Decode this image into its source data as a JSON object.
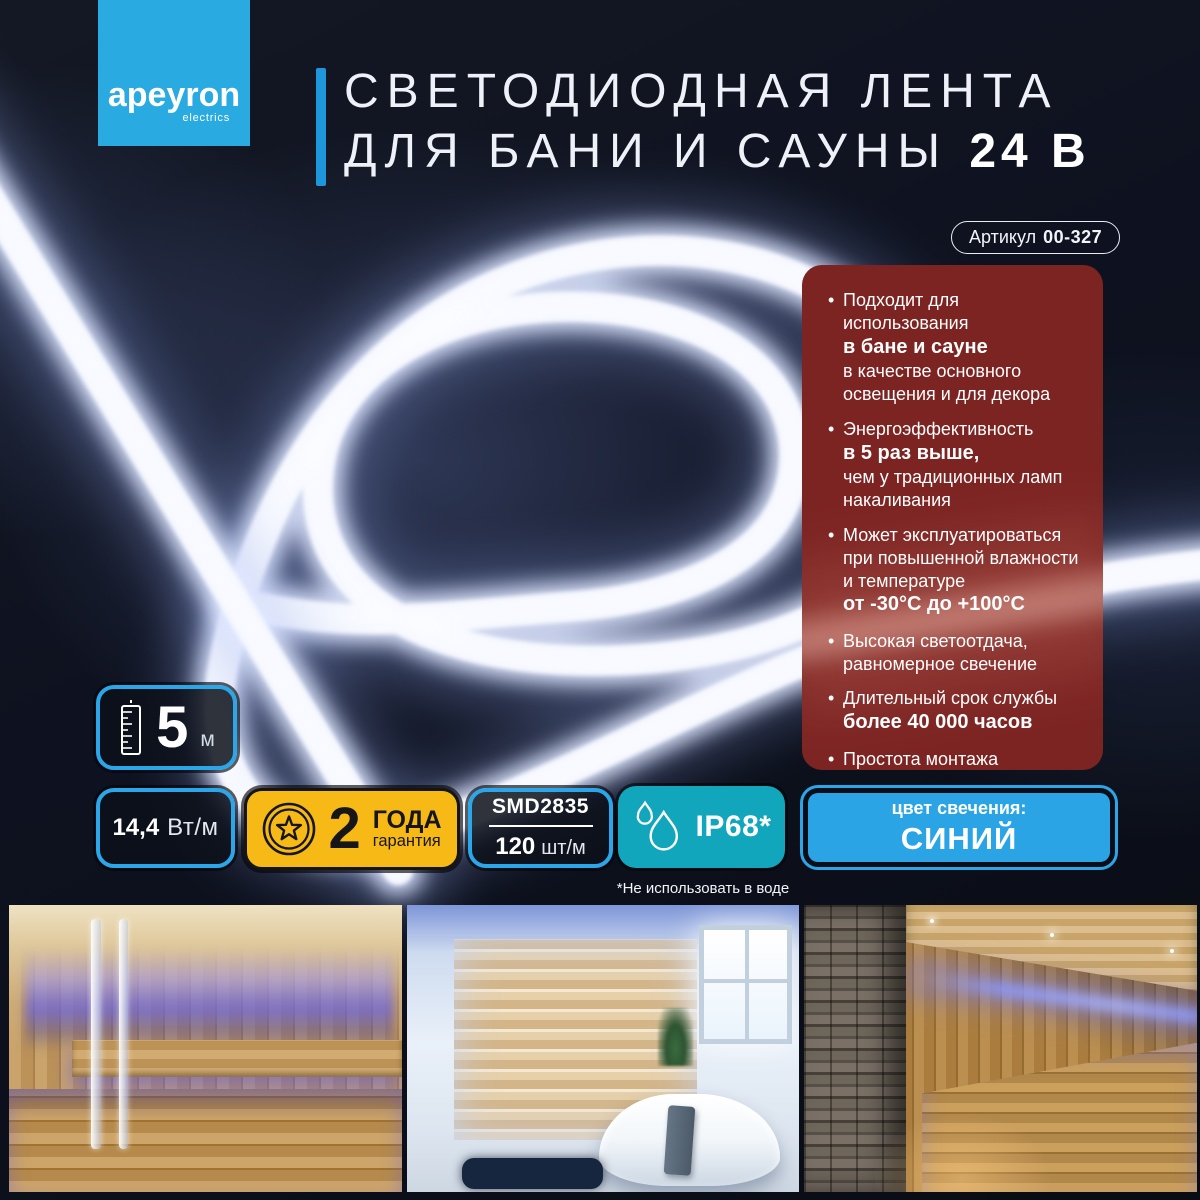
{
  "brand": {
    "name": "apeyron",
    "tagline": "electrics"
  },
  "title": {
    "line1": "СВЕТОДИОДНАЯ ЛЕНТА",
    "line2": "ДЛЯ БАНИ И САУНЫ",
    "voltage": "24 В"
  },
  "article": {
    "label": "Артикул",
    "number": "00-327"
  },
  "features": {
    "items": [
      {
        "t1": "Подходит для использования",
        "b": "в бане и сауне",
        "t2": "в качестве основного освещения и для декора"
      },
      {
        "t1": "Энергоэффективность",
        "b": "в 5 раз выше,",
        "t2": "чем у традиционных ламп накаливания"
      },
      {
        "t1": "Может эксплуатироваться при повышенной влажности и температуре",
        "b": "от -30°С до +100°С",
        "t2": ""
      },
      {
        "t1": "Высокая светоотдача, равномерное свечение",
        "b": "",
        "t2": ""
      },
      {
        "t1": "Длительный срок службы",
        "b": "более 40 000 часов",
        "t2": ""
      },
      {
        "t1": "Простота монтажа",
        "b": "",
        "t2": ""
      }
    ]
  },
  "specs": {
    "length": {
      "value": "5",
      "unit": "м"
    },
    "power": {
      "value": "14,4",
      "unit": "Вт/м"
    },
    "warranty": {
      "value": "2",
      "unit": "ГОДА",
      "label": "гарантия"
    },
    "led": {
      "chip": "SMD2835",
      "density_value": "120",
      "density_unit": "шт/м"
    },
    "protection": {
      "rating": "IP68*",
      "note": "*Не использовать в воде"
    },
    "light_color": {
      "label": "цвет свечения:",
      "value": "СИНИЙ"
    }
  },
  "icons": {
    "length": "ruler-icon",
    "warranty": "medal-star-icon",
    "protection": "water-drops-icon"
  },
  "colors": {
    "accent_blue": "#2BA6E8",
    "logo_cyan": "#29AAE1",
    "warranty_yellow": "#F7B916",
    "ip_teal": "#12A6BC",
    "features_red": "#7C2422",
    "light_color_blue": "#2AA4E4",
    "strip_glow": "#F4F7FF"
  },
  "photos": [
    {
      "name": "sauna-interior-with-blue-led"
    },
    {
      "name": "bathroom-with-tub-and-blue-led"
    },
    {
      "name": "sauna-with-stone-wall-blue-led"
    }
  ]
}
